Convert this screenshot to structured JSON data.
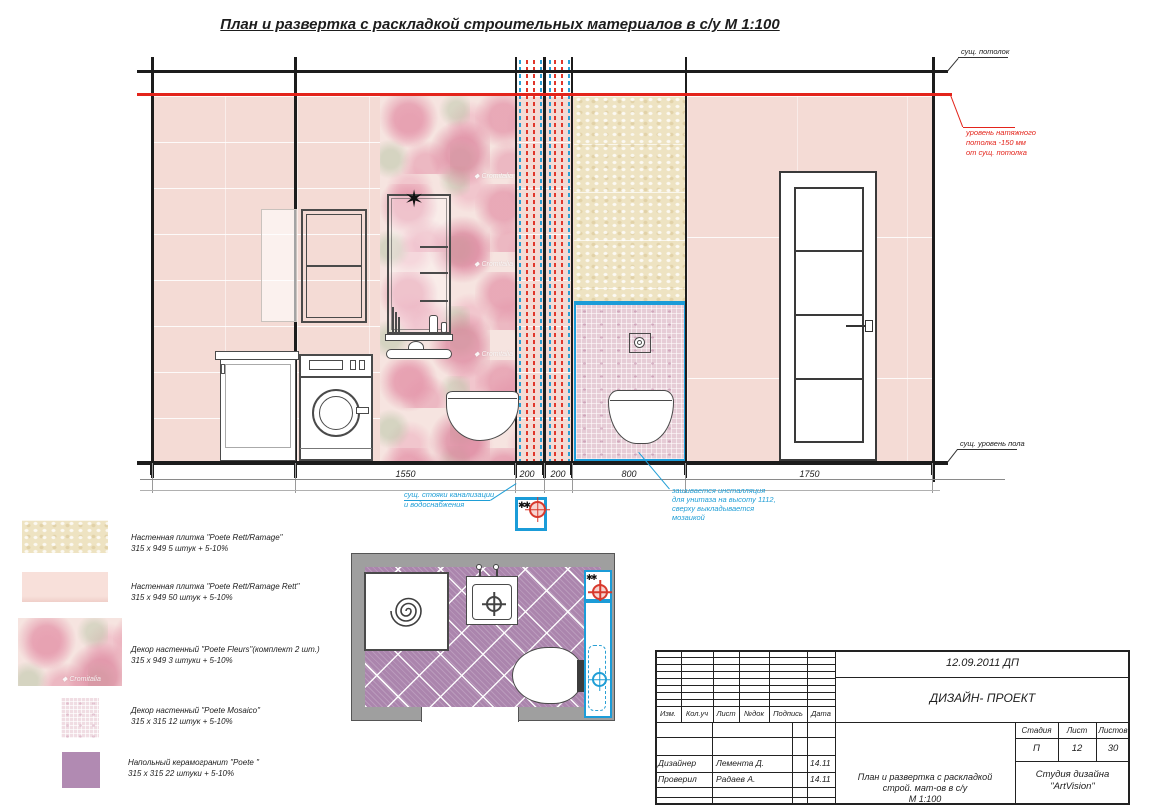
{
  "title": "План и развертка с раскладкой строительных материалов в с/у   М 1:100",
  "annotations": {
    "ceiling": "сущ. потолок",
    "stretch_line1": "уровень натяжного",
    "stretch_line2": "потолка  -150 мм",
    "stretch_line3": "от сущ. потолка",
    "floor": "сущ. уровень пола",
    "stacks_line1": "сущ. стояки канализации",
    "stacks_line2": "и водоснабжения",
    "install_line1": "зашивается инсталляция",
    "install_line2": "для унитаза на высоту 1112,",
    "install_line3": "сверху выкладывается",
    "install_line4": "мозаикой",
    "watermark": "◆ Cromitalia"
  },
  "icons": {
    "sparkle": "✶",
    "stack_symbols": "✱✱"
  },
  "dimensions": {
    "d1": "1550",
    "d2": "200",
    "d3": "200",
    "d4": "800",
    "d5": "1750"
  },
  "legend": {
    "item1": {
      "name": "Настенная плитка \"Poete Rett/Ramage\"",
      "qty": "315 x 949  5 штук + 5-10%"
    },
    "item2": {
      "name": "Настенная плитка \"Poete Rett/Ramage Rett\"",
      "qty": "315 x 949   50 штук + 5-10%"
    },
    "item3": {
      "name": "Декор настенный \"Poete Fleurs\"(комплект 2 шт.)",
      "qty": "315 x 949   3 штуки + 5-10%"
    },
    "item4": {
      "name": "Декор настенный \"Poete Mosaico\"",
      "qty": "315 x 315  12 штук + 5-10%"
    },
    "item5": {
      "name": "Напольный керамогранит \"Poete \"",
      "qty": "315 x 315  22 штуки + 5-10%"
    }
  },
  "titleblock": {
    "date": "12.09.2011   ДП",
    "project": "ДИЗАЙН- ПРОЕКТ",
    "cols": {
      "c1": "Изм.",
      "c2": "Кол.уч",
      "c3": "Лист",
      "c4": "№док",
      "c5": "Подпись",
      "c6": "Дата"
    },
    "row_designer": {
      "role": "Дизайнер",
      "name": "Лемента Д.",
      "date": "14.11"
    },
    "row_checker": {
      "role": "Проверил",
      "name": "Радаев А.",
      "date": "14.11"
    },
    "doc_line1": "План и развертка с раскладкой",
    "doc_line2": "строй. мат-ов в с/у",
    "doc_line3": "М 1:100",
    "stage_label": "Стадия",
    "sheet_label": "Лист",
    "sheets_label": "Листов",
    "stage": "П",
    "sheet": "12",
    "sheets": "30",
    "studio_line1": "Студия дизайна",
    "studio_line2": "\"ArtVision\""
  },
  "colors": {
    "red_accent": "#e3241b",
    "blue_accent": "#1f9ed6",
    "pink_tile": "#f4dbd5",
    "beige_tile": "#eee3c2",
    "mosaic_tile": "#e6ccd6",
    "floor_purple": "#ab85ad",
    "wall_gray": "#9f9f9f"
  }
}
